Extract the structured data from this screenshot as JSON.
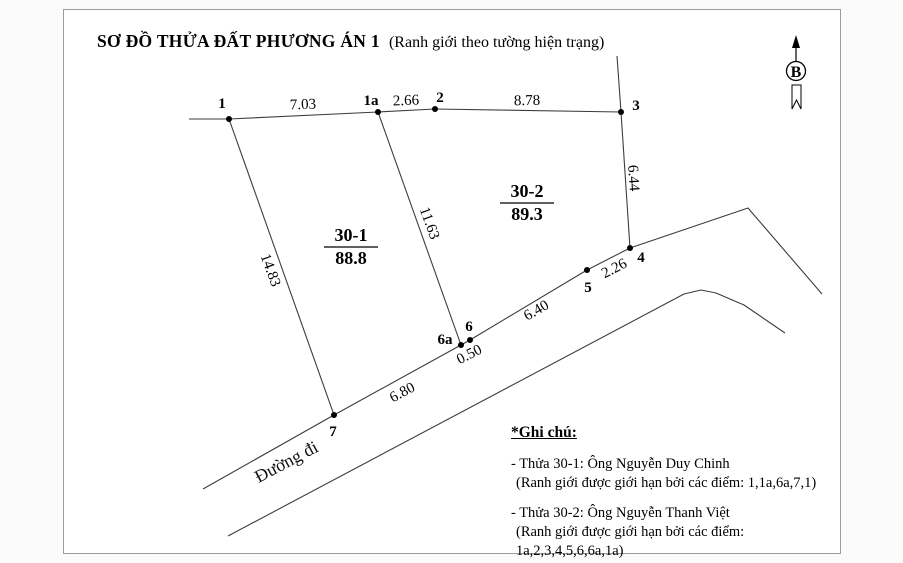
{
  "title": {
    "main": "SƠ ĐỒ THỬA ĐẤT PHƯƠNG ÁN 1",
    "sub": "(Ranh giới theo tường hiện trạng)"
  },
  "compass": {
    "label": "B"
  },
  "colors": {
    "line": "#3d3d3d",
    "frame": "#9c9c9c",
    "text": "#000000",
    "background": "#ffffff"
  },
  "parcels": [
    {
      "id": "30-1",
      "area": "88.8",
      "x": 351,
      "y": 247
    },
    {
      "id": "30-2",
      "area": "89.3",
      "x": 527,
      "y": 203
    }
  ],
  "points": [
    {
      "id": "1",
      "x": 229,
      "y": 119,
      "lx": 222,
      "ly": 108
    },
    {
      "id": "1a",
      "x": 378,
      "y": 112,
      "lx": 371,
      "ly": 105
    },
    {
      "id": "2",
      "x": 435,
      "y": 109,
      "lx": 440,
      "ly": 102
    },
    {
      "id": "3",
      "x": 621,
      "y": 112,
      "lx": 636,
      "ly": 110
    },
    {
      "id": "4",
      "x": 630,
      "y": 248,
      "lx": 641,
      "ly": 262
    },
    {
      "id": "5",
      "x": 587,
      "y": 270,
      "lx": 588,
      "ly": 292
    },
    {
      "id": "6",
      "x": 470,
      "y": 340,
      "lx": 469,
      "ly": 331
    },
    {
      "id": "6a",
      "x": 461,
      "y": 345,
      "lx": 445,
      "ly": 344
    },
    {
      "id": "7",
      "x": 334,
      "y": 415,
      "lx": 333,
      "ly": 436
    }
  ],
  "edges": [
    {
      "name": "north-boundary",
      "points": [
        [
          189,
          119
        ],
        [
          229,
          119
        ],
        [
          378,
          112
        ],
        [
          435,
          109
        ],
        [
          621,
          112
        ]
      ]
    },
    {
      "name": "east-boundary",
      "points": [
        [
          617,
          56
        ],
        [
          621,
          112
        ],
        [
          630,
          248
        ]
      ]
    },
    {
      "name": "west-boundary",
      "points": [
        [
          229,
          119
        ],
        [
          334,
          415
        ]
      ]
    },
    {
      "name": "middle-divider",
      "points": [
        [
          378,
          112
        ],
        [
          461,
          345
        ]
      ]
    },
    {
      "name": "road-upper-edge",
      "points": [
        [
          203,
          489
        ],
        [
          334,
          415
        ],
        [
          461,
          345
        ],
        [
          470,
          340
        ],
        [
          587,
          270
        ],
        [
          630,
          248
        ],
        [
          748,
          208
        ],
        [
          822,
          294
        ]
      ]
    },
    {
      "name": "road-lower-edge",
      "points": [
        [
          228,
          536
        ],
        [
          684,
          294
        ],
        [
          701,
          290
        ],
        [
          716,
          293
        ],
        [
          744,
          305
        ],
        [
          785,
          333
        ]
      ]
    }
  ],
  "measurements": [
    {
      "text": "7.03",
      "x": 303,
      "y": 104,
      "rotate": -2
    },
    {
      "text": "2.66",
      "x": 406,
      "y": 100,
      "rotate": -2
    },
    {
      "text": "8.78",
      "x": 527,
      "y": 100,
      "rotate": -1
    },
    {
      "text": "6.44",
      "x": 634,
      "y": 178,
      "rotate": 86
    },
    {
      "text": "14.83",
      "x": 271,
      "y": 270,
      "rotate": 70
    },
    {
      "text": "11.63",
      "x": 430,
      "y": 223,
      "rotate": 70
    },
    {
      "text": "2.26",
      "x": 614,
      "y": 268,
      "rotate": -27
    },
    {
      "text": "6.40",
      "x": 536,
      "y": 310,
      "rotate": -30
    },
    {
      "text": "0.50",
      "x": 469,
      "y": 354,
      "rotate": -27
    },
    {
      "text": "6.80",
      "x": 402,
      "y": 392,
      "rotate": -28
    }
  ],
  "road_label": {
    "text": "Đường đi",
    "x": 289,
    "y": 467,
    "rotate": -28
  },
  "notes": {
    "heading": "*Ghi chú:",
    "items": [
      {
        "line1": "- Thửa 30-1: Ông Nguyễn Duy Chinh",
        "line2": "(Ranh giới được giới hạn bởi các điểm: 1,1a,6a,7,1)"
      },
      {
        "line1": "- Thửa 30-2: Ông Nguyễn Thanh Việt",
        "line2": "(Ranh giới được giới hạn bởi các điểm: 1a,2,3,4,5,6,6a,1a)"
      }
    ]
  }
}
